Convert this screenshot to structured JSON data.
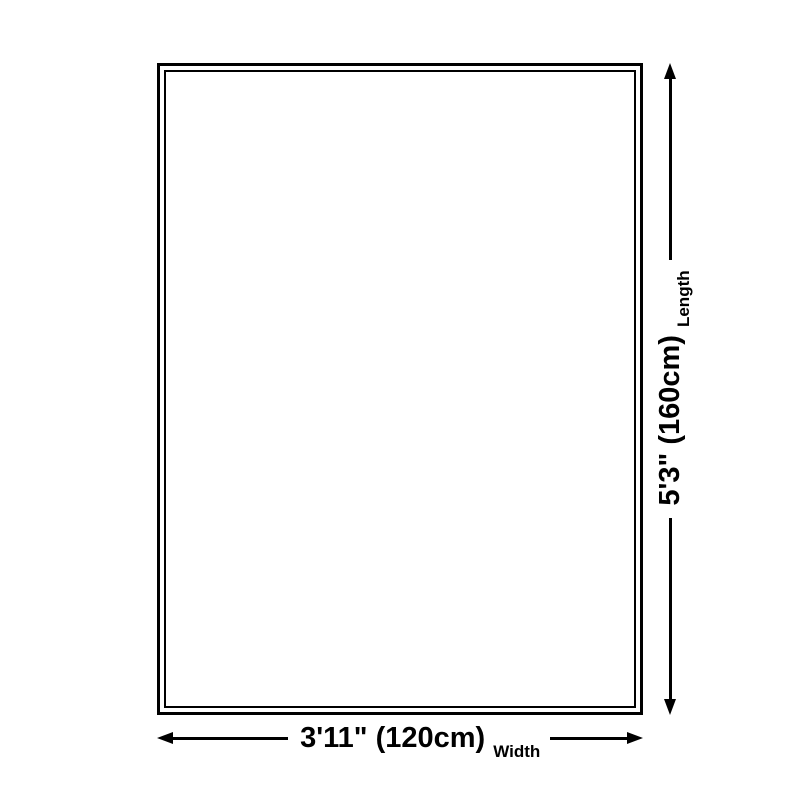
{
  "diagram": {
    "length_dimension": {
      "value": "5'3\" (160cm)",
      "label": "Length"
    },
    "width_dimension": {
      "value": "3'11\" (120cm)",
      "label": "Width"
    },
    "icons": {
      "vertical_arrow": "double-headed-arrow-vertical",
      "horizontal_arrow": "double-headed-arrow-horizontal"
    },
    "colors": {
      "background": "#ffffff",
      "line": "#000000",
      "text": "#000000"
    }
  }
}
